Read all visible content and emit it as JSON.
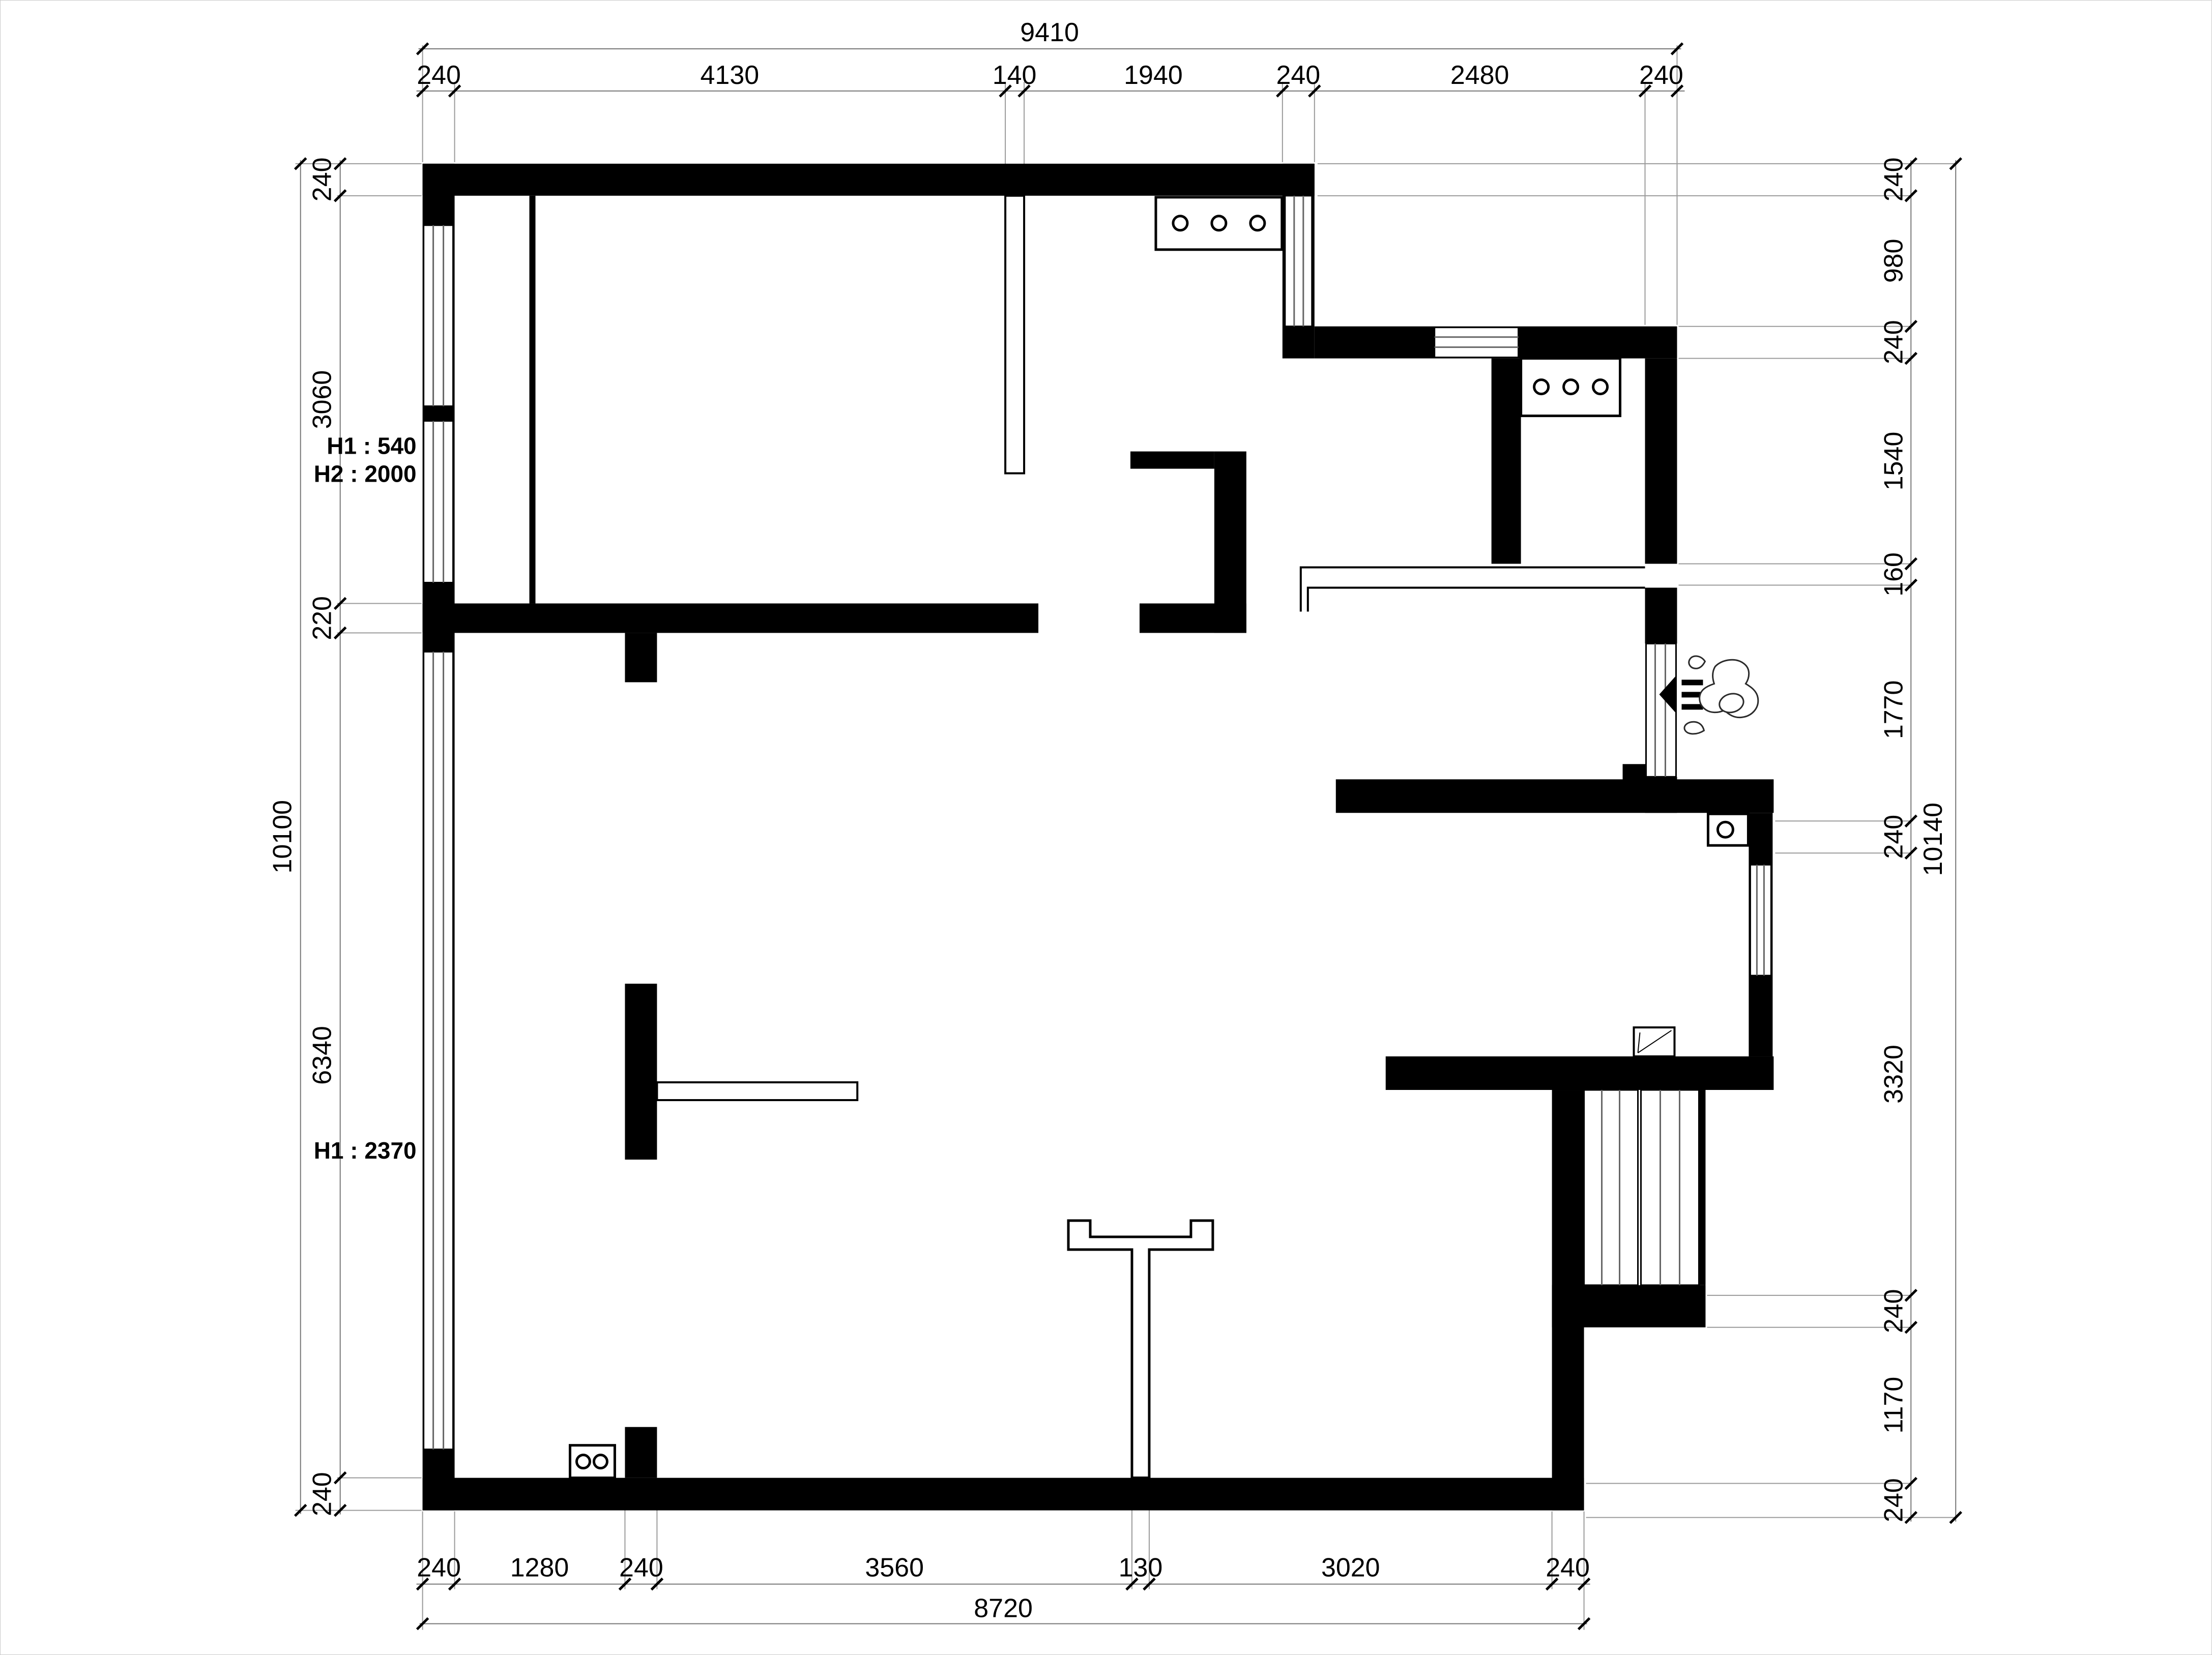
{
  "plan": {
    "kind": "apartment-floor-plan",
    "units": "mm",
    "dims": {
      "top": {
        "total": "9410",
        "segs": [
          "240",
          "4130",
          "140",
          "1940",
          "240",
          "2480",
          "240"
        ]
      },
      "bottom": {
        "total": "8720",
        "segs": [
          "240",
          "1280",
          "240",
          "3560",
          "130",
          "3020",
          "240"
        ]
      },
      "left": {
        "total": "10100",
        "segs": [
          "240",
          "3060",
          "220",
          "6340",
          "240"
        ]
      },
      "right": {
        "total": "10140",
        "segs": [
          "240",
          "980",
          "240",
          "1540",
          "160",
          "1770",
          "240",
          "3320",
          "240",
          "1170",
          "240"
        ]
      }
    },
    "notes": {
      "upper_window_h1": "H1 : 540",
      "upper_window_h2": "H2 : 2000",
      "lower_window_h1": "H1 : 2370"
    }
  }
}
